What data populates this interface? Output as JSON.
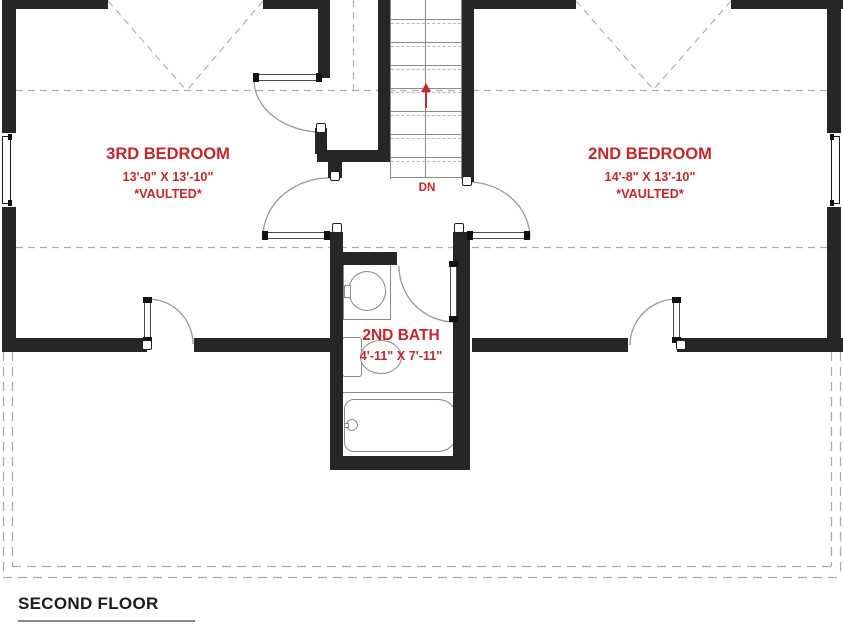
{
  "plan": {
    "floor_title": "SECOND FLOOR",
    "rooms": {
      "bedroom3": {
        "name": "3RD BEDROOM",
        "dimensions": "13'-0\" X 13'-10\"",
        "note": "*VAULTED*"
      },
      "bedroom2": {
        "name": "2ND BEDROOM",
        "dimensions": "14'-8\" X 13'-10\"",
        "note": "*VAULTED*"
      },
      "bath2": {
        "name": "2ND BATH",
        "dimensions": "4'-11\" X 7'-11\""
      }
    },
    "stairs": {
      "label": "DN",
      "direction": "down"
    },
    "fixture_icons": [
      "sink-icon",
      "toilet-icon",
      "bathtub-icon",
      "bathtub-faucet-icon",
      "door-icon",
      "window-icon",
      "stairs-icon",
      "down-arrow-icon"
    ],
    "colors": {
      "wall": "#262626",
      "label_red": "#c3272b",
      "line": "#8a8a8a",
      "dash": "#aeaeae",
      "title": "#1c1c1c",
      "background": "#ffffff"
    }
  }
}
